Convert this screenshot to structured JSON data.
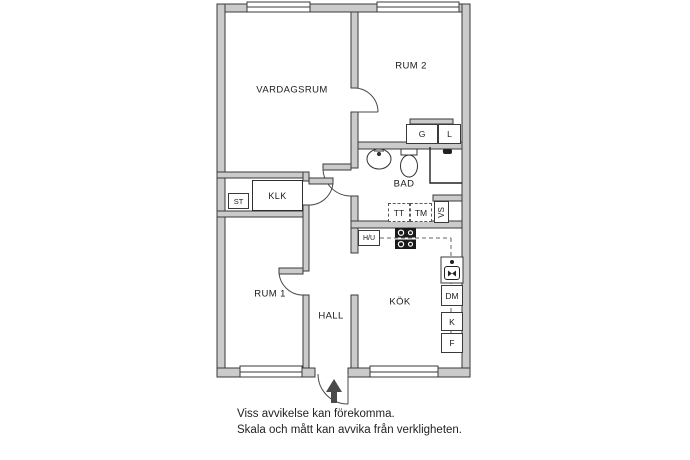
{
  "plan": {
    "rooms": {
      "vardagsrum": "VARDAGSRUM",
      "rum2": "RUM 2",
      "bad": "BAD",
      "klk": "KLK",
      "rum1": "RUM 1",
      "hall": "HALL",
      "kok": "KÖK"
    },
    "closets": {
      "st": "ST",
      "g": "G",
      "l": "L"
    },
    "appliances": {
      "tt": "TT",
      "tm": "TM",
      "vs": "VS",
      "hu": "H/U",
      "dm": "DM",
      "k": "K",
      "f": "F"
    },
    "colors": {
      "background": "#ffffff",
      "wall_fill": "#cbcbcb",
      "wall_line": "#3a3a3a",
      "arrow": "#4a4a4a"
    }
  },
  "disclaimer": {
    "line1": "Viss avvikelse kan förekomma.",
    "line2": "Skala och mått kan avvika från verkligheten."
  }
}
